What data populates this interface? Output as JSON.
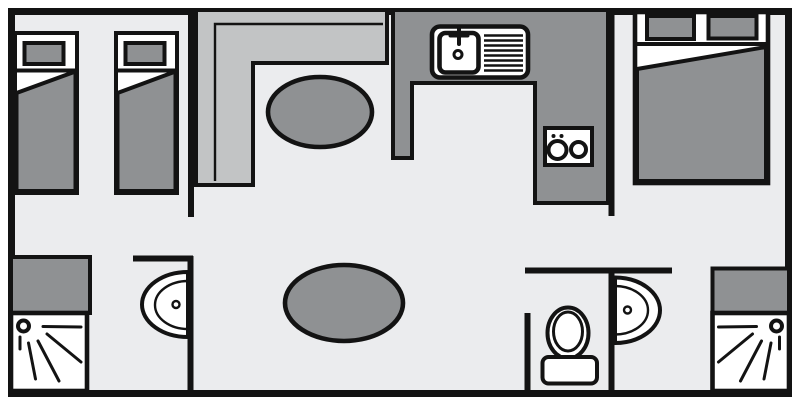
{
  "diagram": {
    "type": "floor-plan",
    "zones": [
      {
        "name": "twin-bedroom",
        "objects": [
          "single-bed",
          "single-bed"
        ]
      },
      {
        "name": "living-area",
        "objects": [
          "l-shaped-sofa",
          "oval-table",
          "oval-table"
        ]
      },
      {
        "name": "kitchen",
        "objects": [
          "u-shaped-counter",
          "sink-with-drainer",
          "two-burner-hob"
        ]
      },
      {
        "name": "double-bedroom",
        "objects": [
          "double-bed",
          "pillow",
          "pillow"
        ]
      },
      {
        "name": "shower-room-left",
        "objects": [
          "storage-cabinet",
          "shower-tray",
          "washbasin"
        ]
      },
      {
        "name": "wc",
        "objects": [
          "toilet",
          "washbasin"
        ]
      },
      {
        "name": "shower-room-right",
        "objects": [
          "storage-cabinet",
          "shower-tray"
        ]
      }
    ]
  },
  "colors": {
    "background": "#ffffff",
    "floor": "#ebecee",
    "wall": "#131313",
    "sofa": "#c2c4c5",
    "furniture": "#8f9193",
    "fixture": "#ffffff"
  }
}
